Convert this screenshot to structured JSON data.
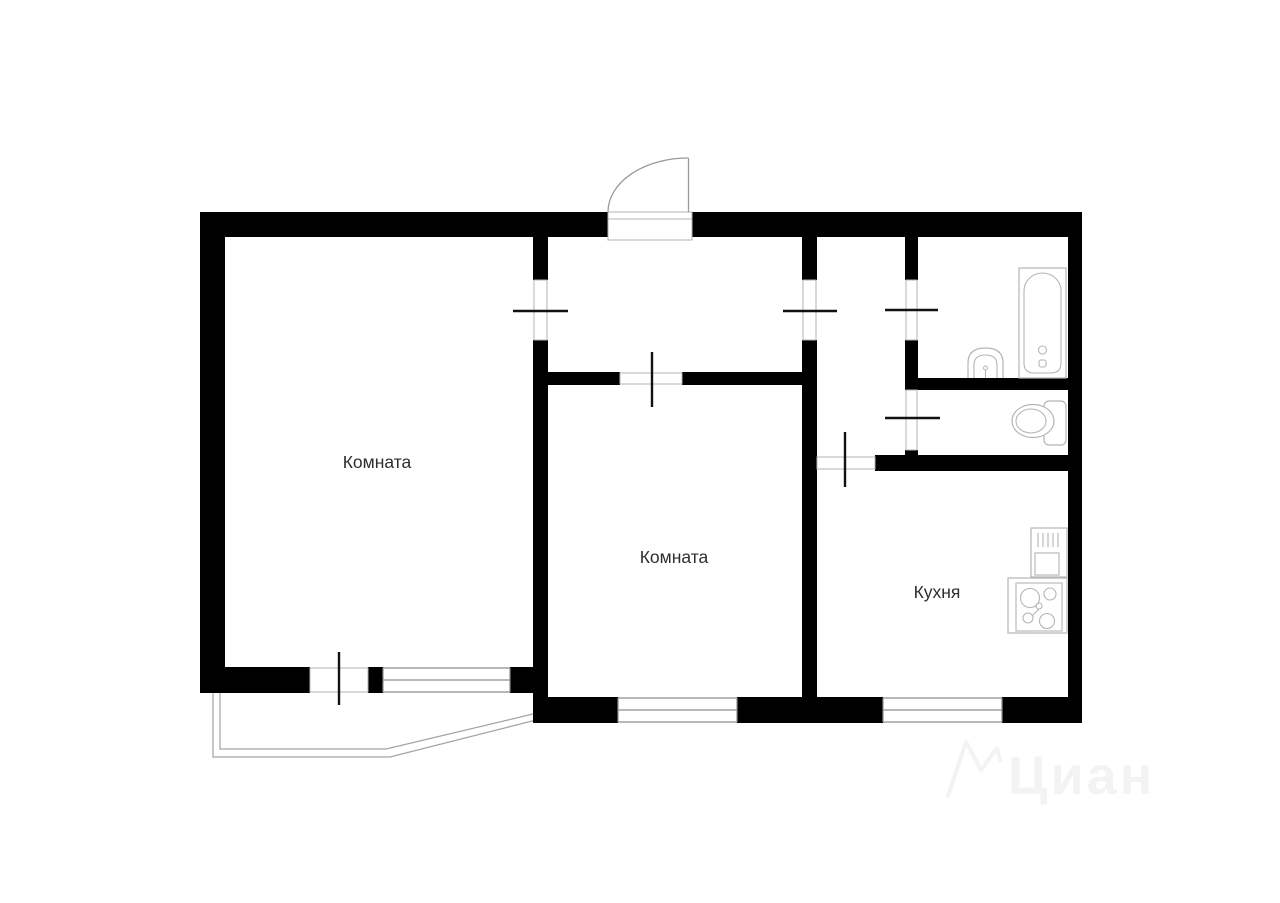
{
  "plan": {
    "rooms": [
      {
        "id": "room-left",
        "label": "Комната"
      },
      {
        "id": "room-middle",
        "label": "Комната"
      },
      {
        "id": "kitchen",
        "label": "Кухня"
      }
    ],
    "fixtures": [
      "bathtub-icon",
      "bathroom-sink-icon",
      "toilet-icon",
      "kitchen-sink-counter-icon",
      "stove-icon",
      "entrance-door-swing-icon",
      "balcony-outline"
    ],
    "colors": {
      "wall": "#000000",
      "sill": "#b3b3b3",
      "door_tick": "#111111",
      "window_line": "#8d8d8d",
      "fixture_outline": "#b5b5b5",
      "label_text": "#2d2d2d",
      "watermark": "#f3f3f3"
    }
  },
  "watermark": {
    "text": "Циан"
  }
}
